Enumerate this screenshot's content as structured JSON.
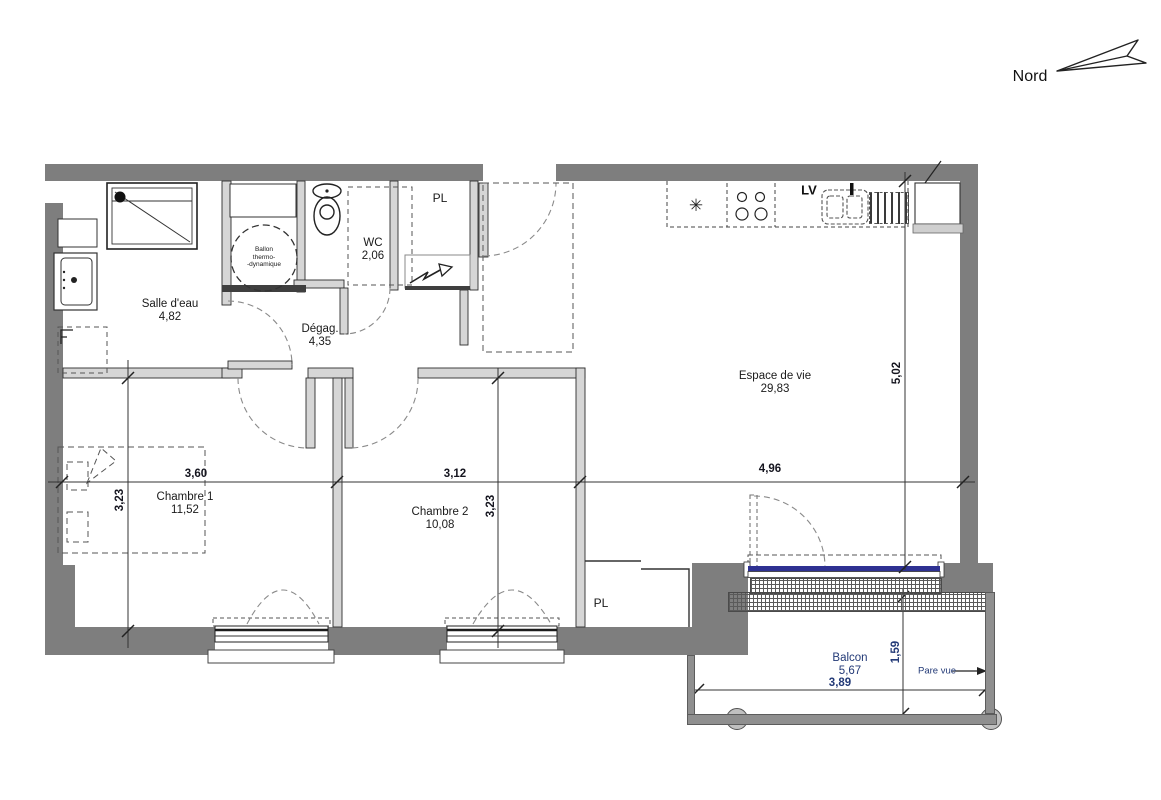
{
  "north": {
    "label": "Nord"
  },
  "rooms": [
    {
      "name": "Salle d'eau",
      "area": "4,82"
    },
    {
      "name": "WC",
      "area": "2,06"
    },
    {
      "name": "Dégag.",
      "area": "4,35"
    },
    {
      "name": "Espace de vie",
      "area": "29,83"
    },
    {
      "name": "Chambre 1",
      "area": "11,52"
    },
    {
      "name": "Chambre 2",
      "area": "10,08"
    },
    {
      "name": "Balcon",
      "area": "5,67"
    }
  ],
  "closets": {
    "hall_label": "PL",
    "bedroom_label": "PL"
  },
  "labels": {
    "dishwasher": "LV",
    "pare_vue": "Pare vue",
    "water_heater_line1": "Ballon",
    "water_heater_line2": "thermo-",
    "water_heater_line3": "-dynamique",
    "fridge_symbol": "✳"
  },
  "dimensions": {
    "chambre1_width": "3,60",
    "chambre2_width": "3,12",
    "living_width": "4,96",
    "chambre1_depth": "3,23",
    "chambre2_depth": "3,23",
    "living_depth": "5,02",
    "balcon_depth": "1,59",
    "balcon_width": "3,89"
  },
  "colors": {
    "exterior_wall": "#7e7e7e",
    "partition": "#d6d6d6",
    "glazing": "#2e3192",
    "text": "#1a1a1a",
    "balcony_text": "#233a77"
  }
}
